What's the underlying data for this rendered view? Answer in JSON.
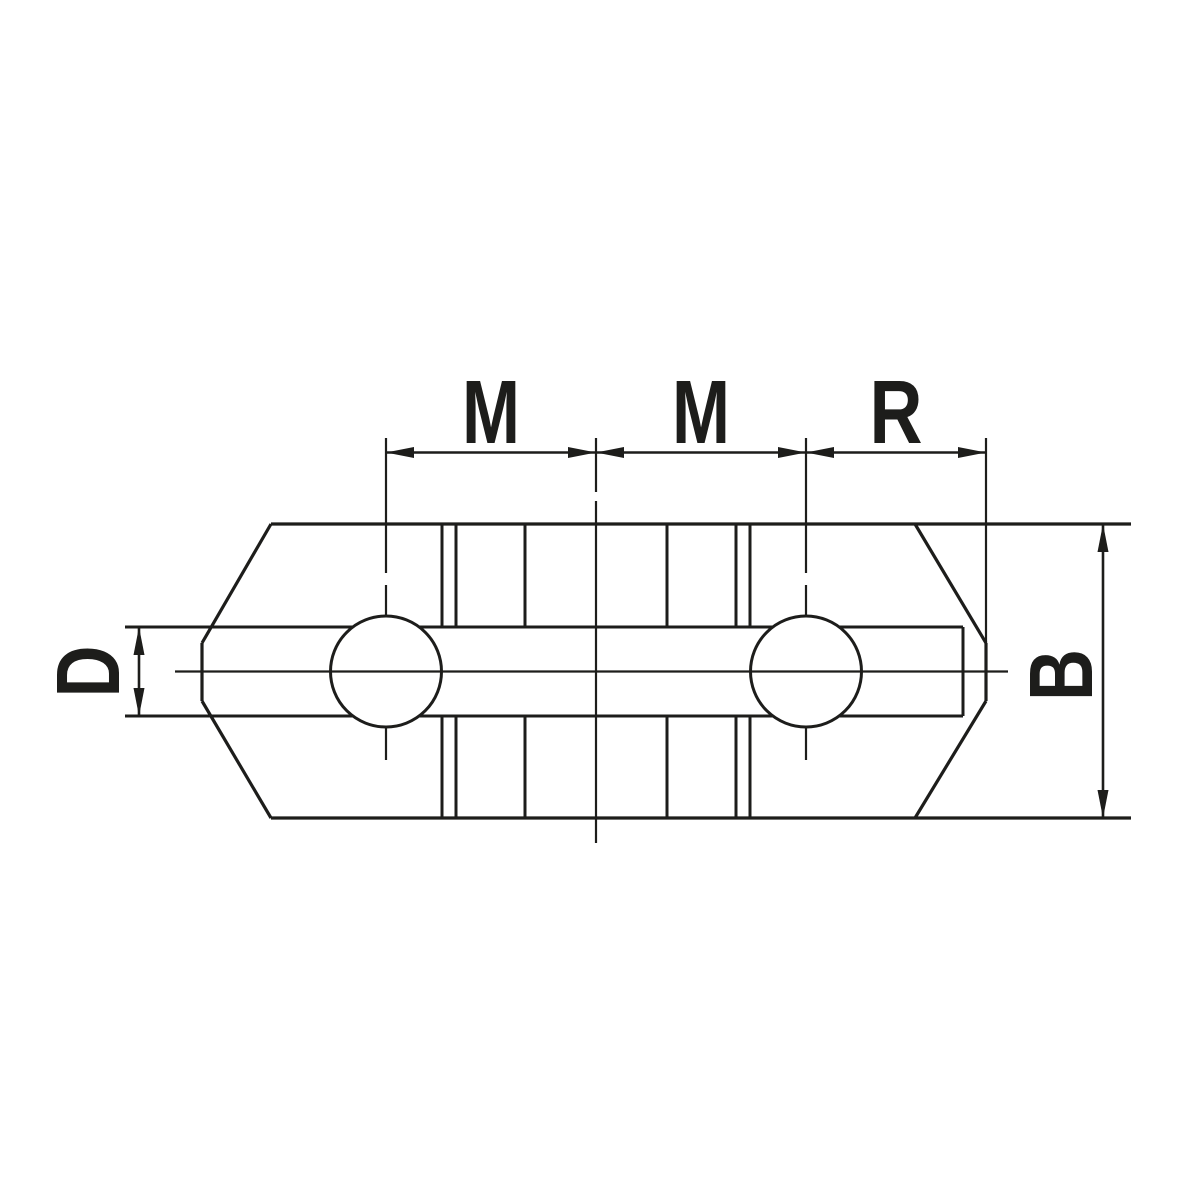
{
  "drawing": {
    "background_color": "#ffffff",
    "line_color": "#1d1d1b",
    "dimensions": {
      "top": [
        {
          "label": "M"
        },
        {
          "label": "M"
        },
        {
          "label": "R"
        }
      ],
      "left": {
        "label": "D"
      },
      "right": {
        "label": "B"
      }
    }
  }
}
